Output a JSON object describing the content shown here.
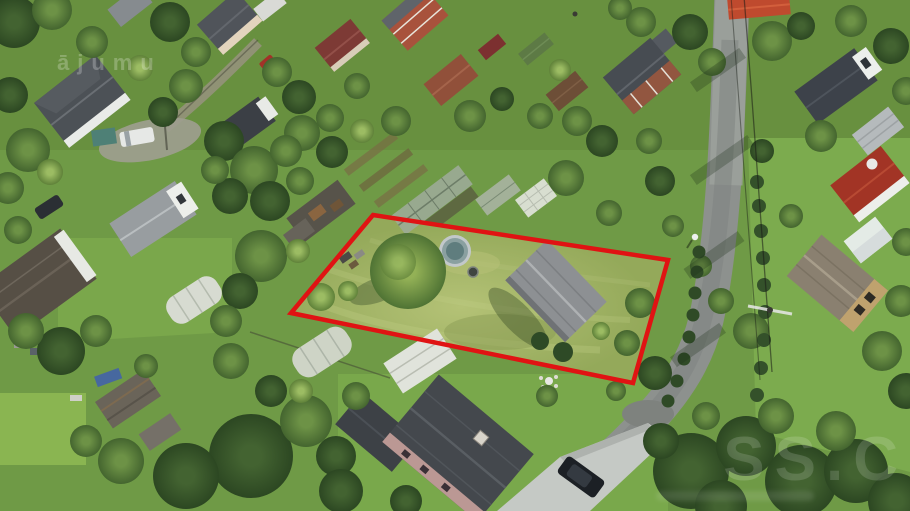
{
  "watermarks": {
    "top_left": "ājumu",
    "bottom_right_large": "SS.C"
  },
  "plot_outline": {
    "points": "373,215 668,260 633,383 291,313",
    "color": "#e01313",
    "stroke_width": "4.5"
  },
  "palette": {
    "outline_red": "#e01313",
    "grass_base": "#6f9a46",
    "grass_plot": "#a9b967",
    "grass_bright": "#7cab4e",
    "tree_dark": "#2f4a24",
    "tree_mid": "#55793a",
    "tree_light": "#94b55e",
    "road_asphalt": "#8d918e",
    "driveway_concrete": "#c5c9c5",
    "roof_dark_gray": "#4b5054",
    "roof_charcoal": "#3d424a",
    "roof_red": "#a23425",
    "roof_orange": "#bf4a2e",
    "roof_maroon": "#7d3a35",
    "roof_brick": "#a8523c",
    "roof_weathered_tan": "#8a8070",
    "wall_white": "#eceeea",
    "wall_pink": "#bb9894",
    "pool_water": "#5f7d7e",
    "greenhouse_white": "#d7dbd1"
  }
}
